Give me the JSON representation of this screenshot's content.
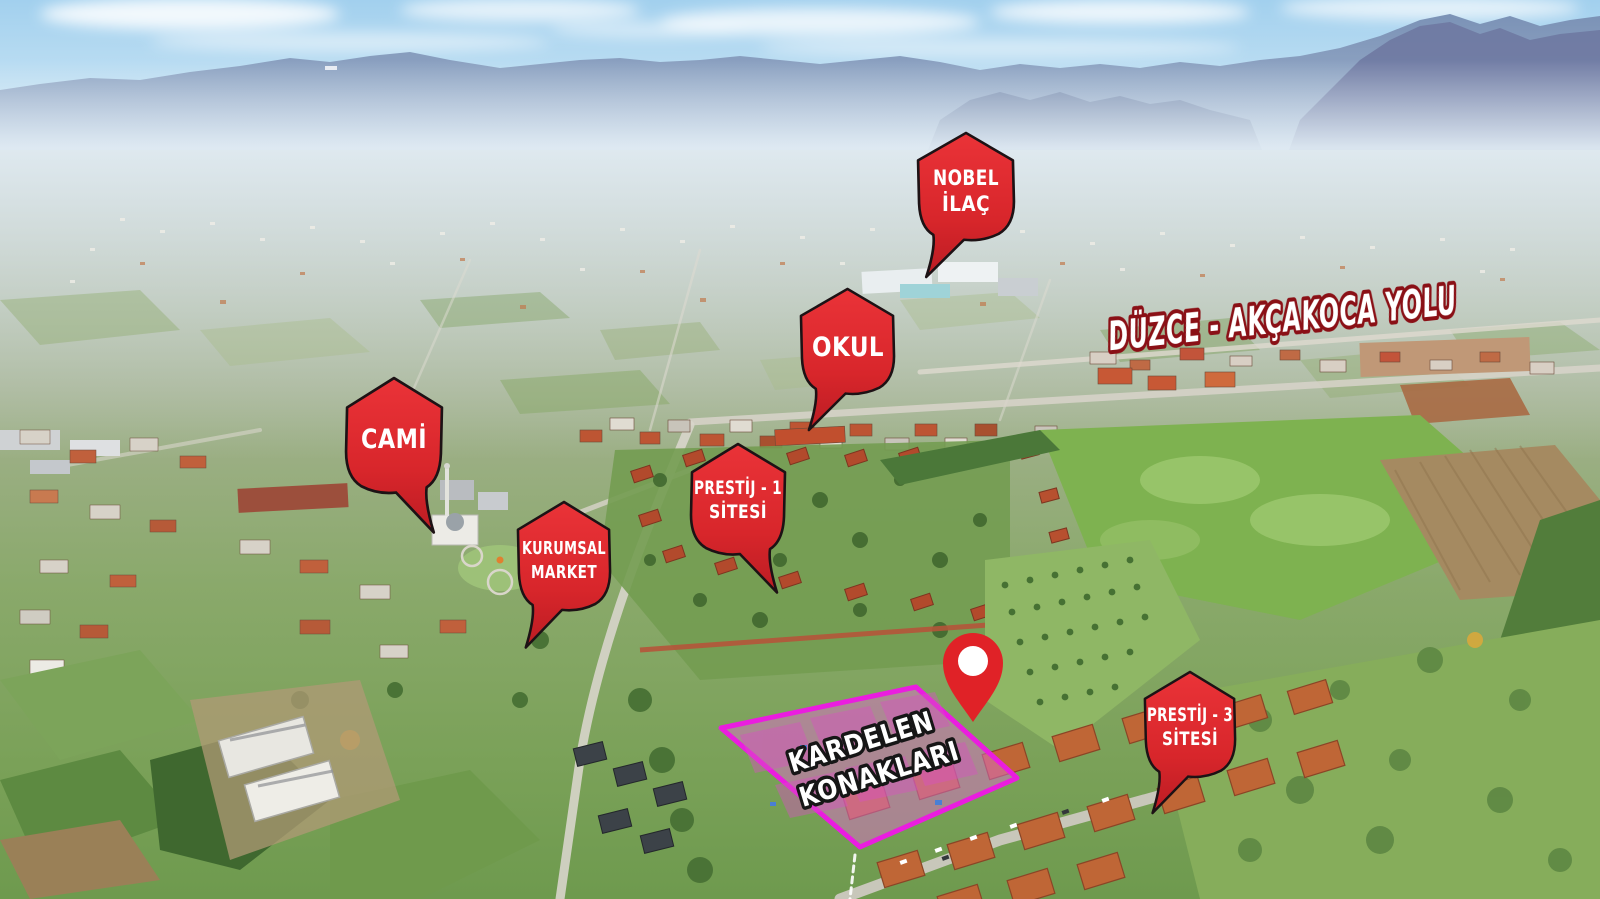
{
  "road_label": {
    "text": "DÜZCE - AKÇAKOCA YOLU"
  },
  "markers": [
    {
      "id": "nobel-ilac",
      "lines": [
        "NOBEL",
        "İLAÇ"
      ]
    },
    {
      "id": "okul",
      "lines": [
        "OKUL"
      ]
    },
    {
      "id": "cami",
      "lines": [
        "CAMİ"
      ]
    },
    {
      "id": "prestij-1-sitesi",
      "lines": [
        "PRESTİJ - 1",
        "SİTESİ"
      ]
    },
    {
      "id": "kurumsal-market",
      "lines": [
        "KURUMSAL",
        "MARKET"
      ]
    },
    {
      "id": "prestij-3-sitesi",
      "lines": [
        "PRESTİJ - 3",
        "SİTESİ"
      ]
    }
  ],
  "site_area": {
    "label_lines": [
      "KARDELEN",
      "KONAKLARI"
    ]
  },
  "pin": {
    "icon": "location-pin"
  },
  "colors": {
    "marker_red": "#d8262b",
    "marker_outline": "#1d1215",
    "marker_text": "#ffffff",
    "road_label_fill": "#ffffff",
    "road_label_outline": "#8a1016",
    "site_outline_magenta": "#ea1ddf",
    "site_fill_pink": "rgba(219,110,204,0.50)",
    "site_label_fill": "#ffffff",
    "site_label_outline": "#161616",
    "pin_red": "#e02227",
    "pin_hole_white": "#ffffff"
  }
}
